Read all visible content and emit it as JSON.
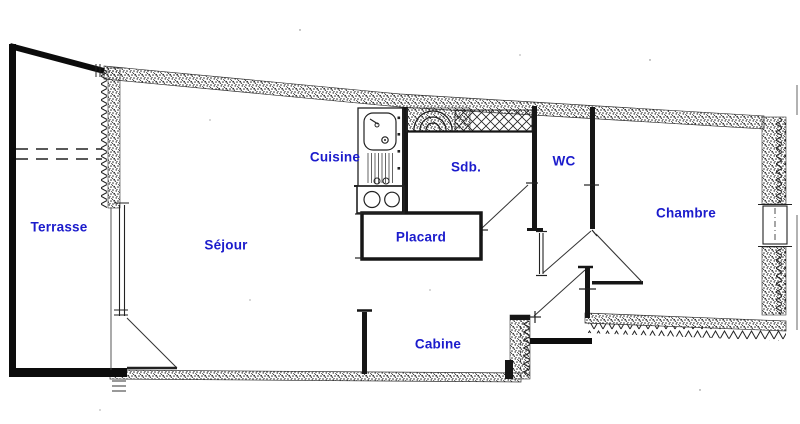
{
  "floorplan": {
    "title": "apartment-floor-plan",
    "background_color": "#ffffff",
    "ink_color": "#1d1d1d",
    "label_color": "#1b1bcc",
    "rooms": [
      {
        "id": "terrasse",
        "label": "Terrasse"
      },
      {
        "id": "sejour",
        "label": "Séjour"
      },
      {
        "id": "cuisine",
        "label": "Cuisine"
      },
      {
        "id": "sdb",
        "label": "Sdb."
      },
      {
        "id": "wc",
        "label": "WC"
      },
      {
        "id": "chambre",
        "label": "Chambre"
      },
      {
        "id": "placard",
        "label": "Placard"
      },
      {
        "id": "cabine",
        "label": "Cabine"
      }
    ],
    "fixtures": [
      {
        "name": "kitchen-sink"
      },
      {
        "name": "stove-two-burners"
      },
      {
        "name": "bathtub"
      },
      {
        "name": "terrace-door-swing"
      },
      {
        "name": "entrance-door-swing"
      },
      {
        "name": "bedroom-door-swing"
      },
      {
        "name": "wc-door-swing"
      },
      {
        "name": "bathroom-door-swing"
      },
      {
        "name": "window-right-wall"
      },
      {
        "name": "window-terrace-wall"
      }
    ]
  }
}
